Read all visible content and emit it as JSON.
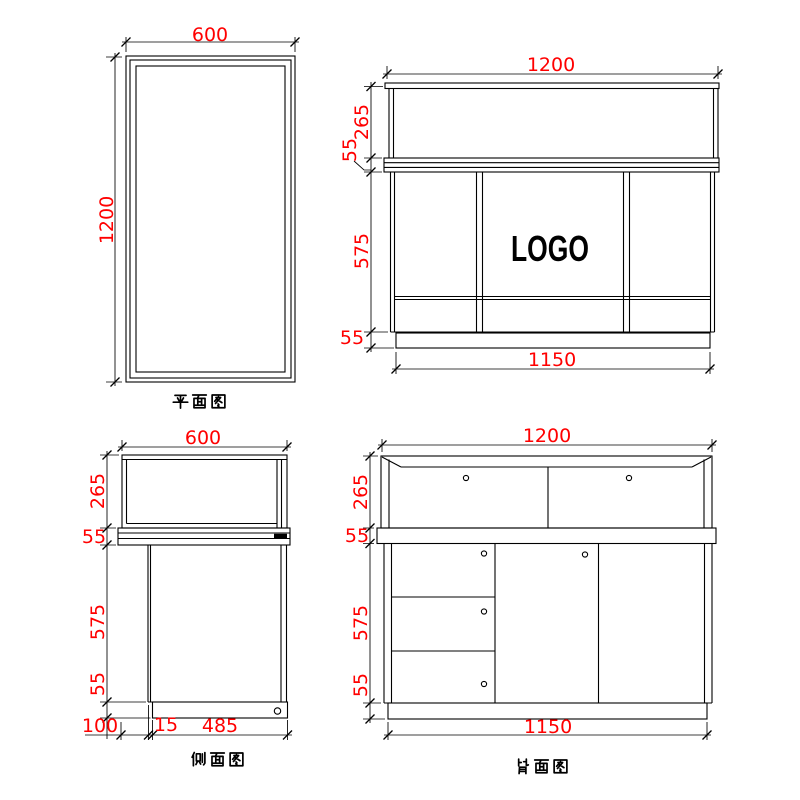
{
  "colors": {
    "line": "#000000",
    "dimension_text": "#ff0000",
    "background": "#ffffff",
    "logo": "#000000"
  },
  "views": {
    "plan": {
      "label": "平面图",
      "dims": {
        "width": "600",
        "height": "1200"
      }
    },
    "front": {
      "logo": "LOGO",
      "dims": {
        "top_width": "1200",
        "glass_height": "265",
        "counter_height": "55",
        "body_height": "575",
        "plinth_height": "55",
        "base_width": "1150"
      }
    },
    "side": {
      "label": "侧面图",
      "dims": {
        "top_width": "600",
        "glass_height": "265",
        "counter_height": "55",
        "body_height": "575",
        "plinth_height": "55",
        "base_overhang": "100",
        "base_panel": "15",
        "base_depth": "485"
      }
    },
    "back": {
      "label": "背面图",
      "dims": {
        "top_width": "1200",
        "glass_height": "265",
        "counter_height": "55",
        "body_height": "575",
        "plinth_height": "55",
        "base_width": "1150"
      }
    }
  }
}
